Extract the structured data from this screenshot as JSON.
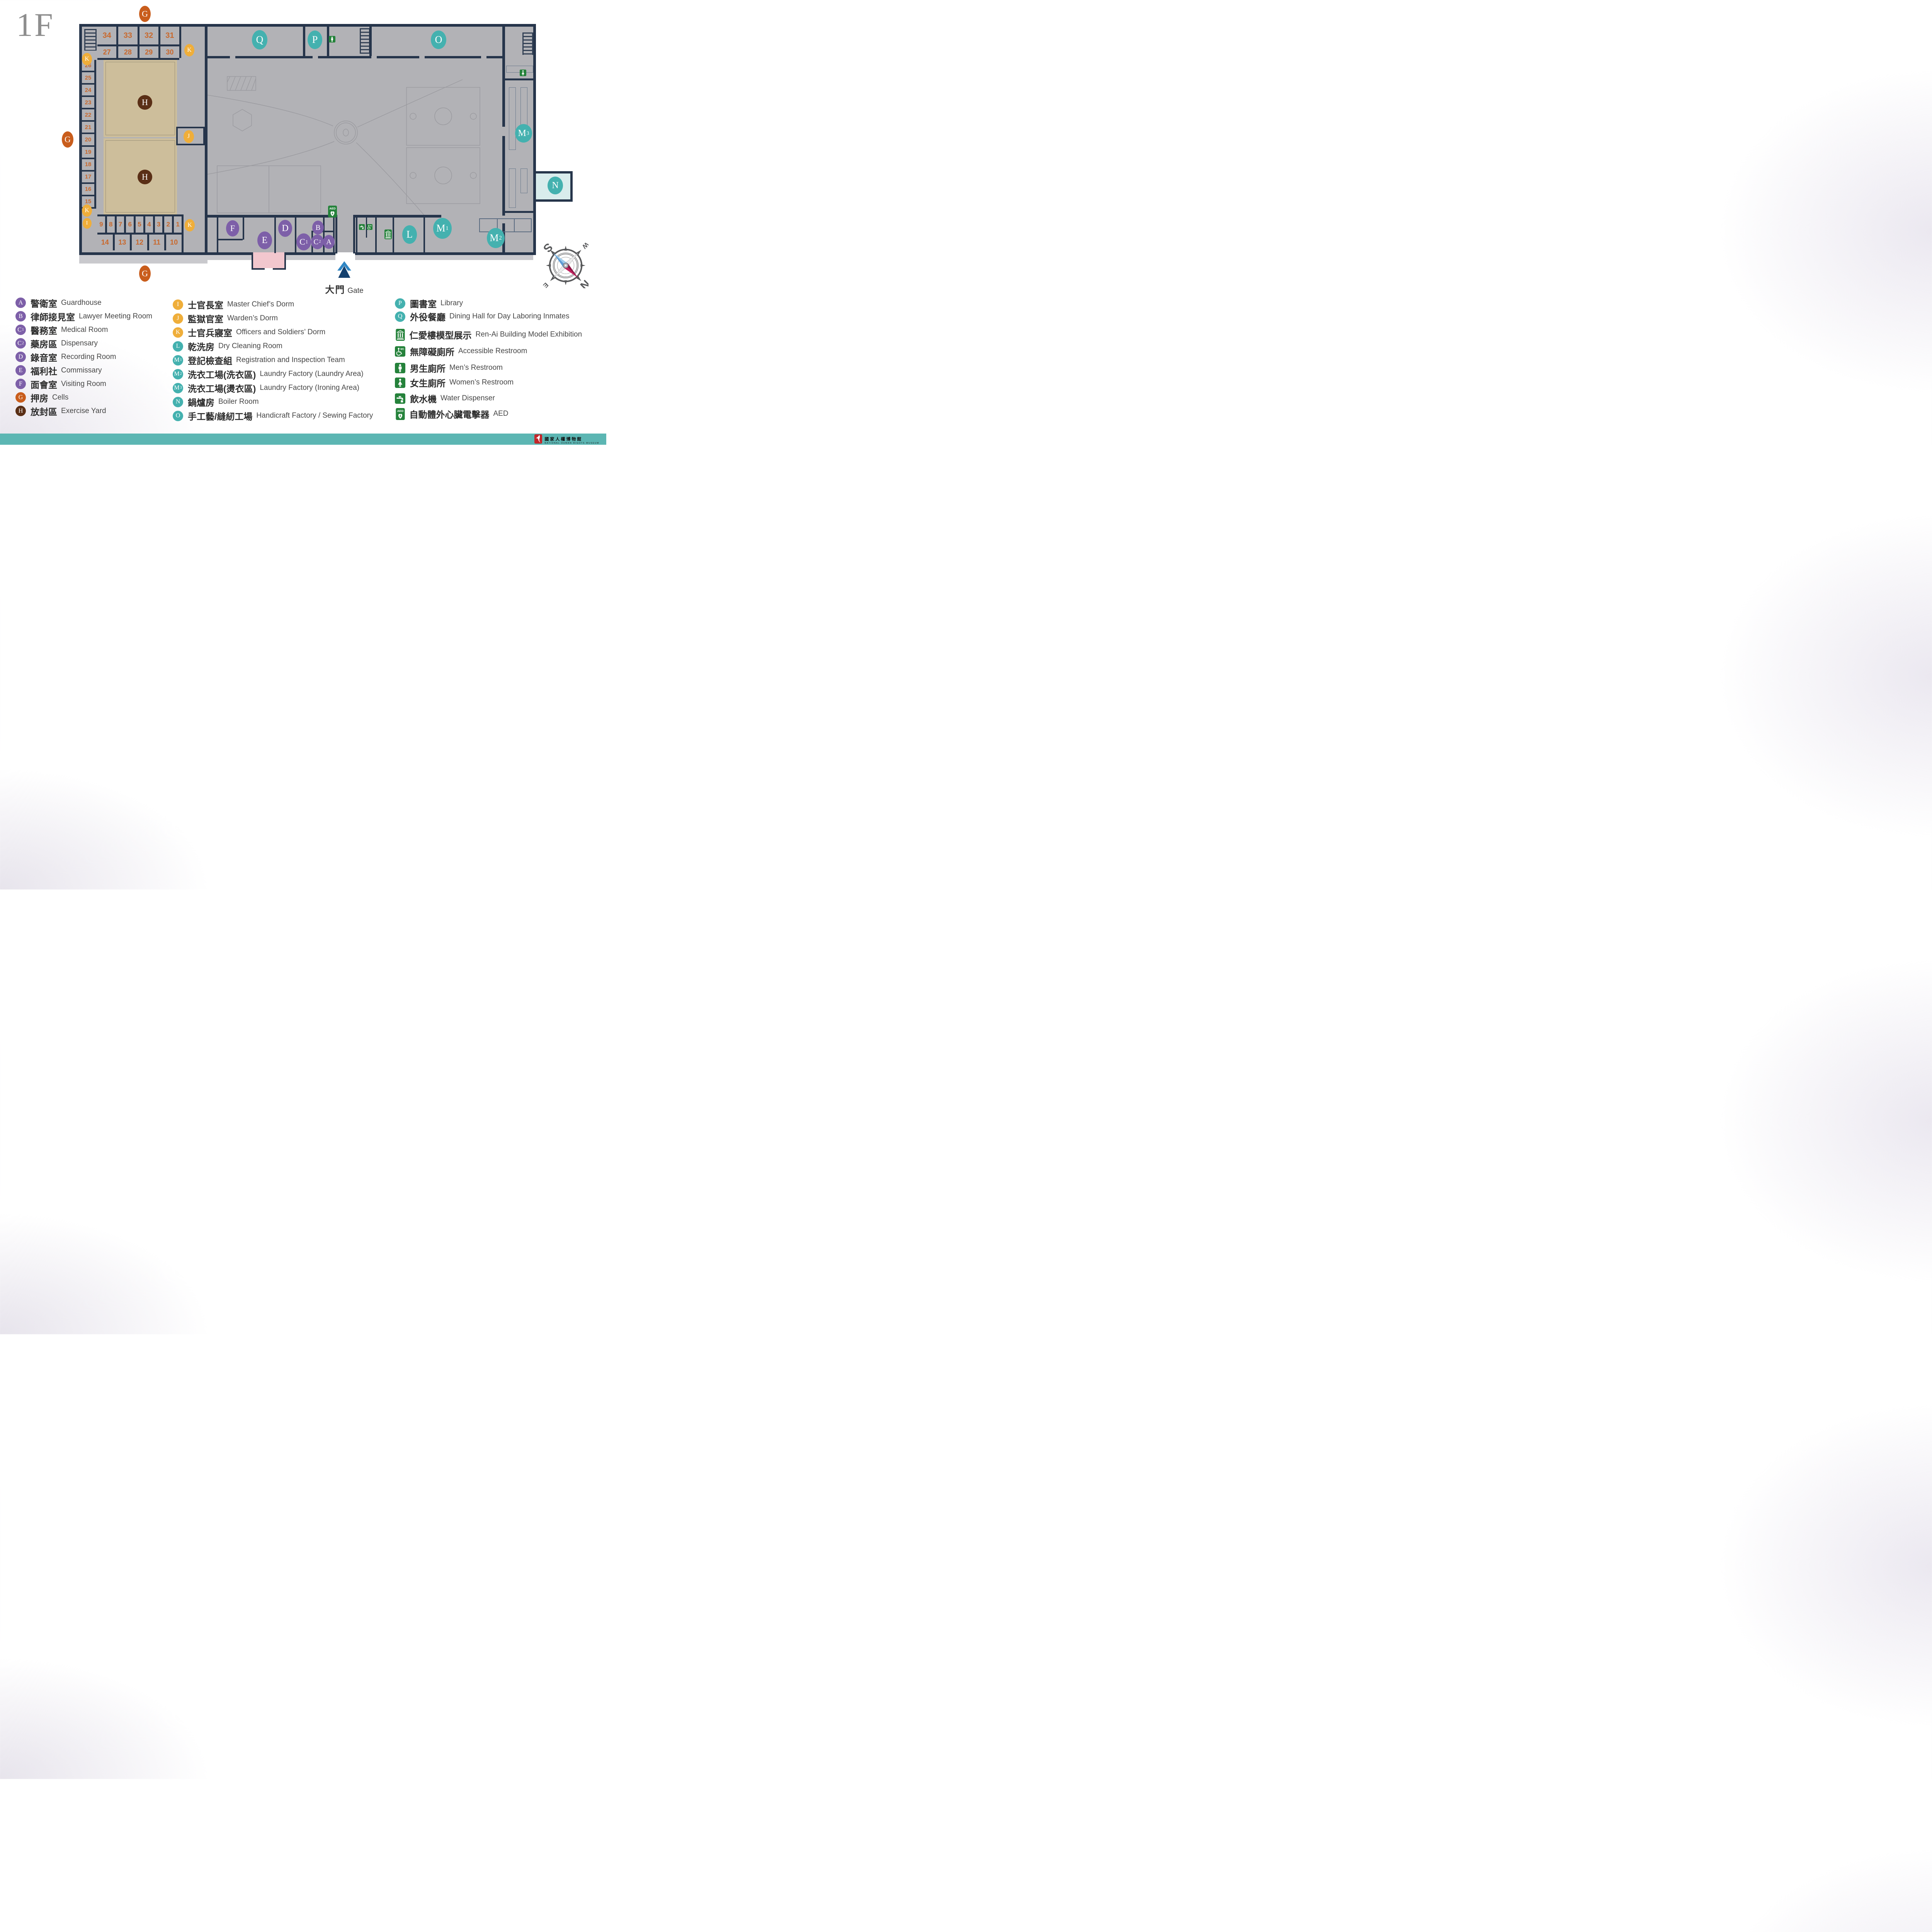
{
  "title": "1F",
  "palette": {
    "purple": "#7D5FA8",
    "orange": "#C95D1C",
    "brown": "#5A2F16",
    "yellow": "#EFAE3A",
    "teal": "#44B1AF",
    "green": "#25823B",
    "wall": "#26354B",
    "cell_beige": "#EDE1BE",
    "yard_tan": "#CDBE9B",
    "courtyard_gray": "#B2B2B6",
    "room_cyan": "#D9ECEC",
    "room_pink": "#F2C7CE",
    "footer_teal": "#5CB6B3",
    "number_orange": "#C9682C",
    "gate_blue_light": "#2F86C4",
    "gate_blue_dark": "#14406E",
    "logo_red": "#C3272B"
  },
  "map": {
    "cell_numbers": {
      "top_row_1": [
        "34",
        "33",
        "32",
        "31"
      ],
      "top_row_2": [
        "27",
        "28",
        "29",
        "30"
      ],
      "left_column": [
        "26",
        "25",
        "24",
        "23",
        "22",
        "21",
        "20",
        "19",
        "18",
        "17",
        "16",
        "15"
      ],
      "bottom_row_1": [
        "9",
        "8",
        "7",
        "6",
        "5",
        "4",
        "3",
        "2",
        "1"
      ],
      "bottom_row_2": [
        "14",
        "13",
        "12",
        "11",
        "10"
      ]
    },
    "markers": [
      {
        "letter": "G",
        "sub": "",
        "color": "orange"
      },
      {
        "letter": "G",
        "sub": "",
        "color": "orange"
      },
      {
        "letter": "G",
        "sub": "",
        "color": "orange"
      },
      {
        "letter": "K",
        "sub": "",
        "color": "yellow"
      },
      {
        "letter": "K",
        "sub": "",
        "color": "yellow"
      },
      {
        "letter": "K",
        "sub": "",
        "color": "yellow"
      },
      {
        "letter": "I",
        "sub": "",
        "color": "yellow"
      },
      {
        "letter": "K",
        "sub": "",
        "color": "yellow"
      },
      {
        "letter": "J",
        "sub": "",
        "color": "yellow"
      },
      {
        "letter": "H",
        "sub": "",
        "color": "brown"
      },
      {
        "letter": "H",
        "sub": "",
        "color": "brown"
      },
      {
        "letter": "Q",
        "sub": "",
        "color": "teal"
      },
      {
        "letter": "P",
        "sub": "",
        "color": "teal"
      },
      {
        "letter": "O",
        "sub": "",
        "color": "teal"
      },
      {
        "letter": "M",
        "sub": "3",
        "color": "teal"
      },
      {
        "letter": "N",
        "sub": "",
        "color": "teal"
      },
      {
        "letter": "L",
        "sub": "",
        "color": "teal"
      },
      {
        "letter": "M",
        "sub": "1",
        "color": "teal"
      },
      {
        "letter": "M",
        "sub": "2",
        "color": "teal"
      },
      {
        "letter": "F",
        "sub": "",
        "color": "purple"
      },
      {
        "letter": "E",
        "sub": "",
        "color": "purple"
      },
      {
        "letter": "D",
        "sub": "",
        "color": "purple"
      },
      {
        "letter": "C",
        "sub": "1",
        "color": "purple"
      },
      {
        "letter": "C",
        "sub": "2",
        "color": "purple"
      },
      {
        "letter": "B",
        "sub": "",
        "color": "purple"
      },
      {
        "letter": "A",
        "sub": "",
        "color": "purple"
      }
    ],
    "icons": [
      {
        "name": "men-restroom-icon"
      },
      {
        "name": "women-restroom-icon"
      },
      {
        "name": "aed-icon"
      },
      {
        "name": "water-dispenser-icon"
      },
      {
        "name": "accessible-restroom-icon"
      },
      {
        "name": "museum-icon"
      }
    ]
  },
  "gate": {
    "zh": "大門",
    "en": "Gate"
  },
  "compass": {
    "n": "N",
    "ne": "NE",
    "e": "E",
    "se": "SE",
    "s": "S",
    "sw": "SW",
    "w": "W",
    "nw": "NW"
  },
  "legend": {
    "columns": [
      {
        "items": [
          {
            "letter": "A",
            "sub": "",
            "color": "purple",
            "zh": "警衛室",
            "en": "Guardhouse"
          },
          {
            "letter": "B",
            "sub": "",
            "color": "purple",
            "zh": "律師接見室",
            "en": "Lawyer Meeting Room"
          },
          {
            "letter": "C",
            "sub": "1",
            "color": "purple",
            "zh": "醫務室",
            "en": "Medical Room"
          },
          {
            "letter": "C",
            "sub": "2",
            "color": "purple",
            "zh": "藥房區",
            "en": "Dispensary"
          },
          {
            "letter": "D",
            "sub": "",
            "color": "purple",
            "zh": "錄音室",
            "en": "Recording Room"
          },
          {
            "letter": "E",
            "sub": "",
            "color": "purple",
            "zh": "福利社",
            "en": "Commissary"
          },
          {
            "letter": "F",
            "sub": "",
            "color": "purple",
            "zh": "面會室",
            "en": "Visiting Room"
          },
          {
            "letter": "G",
            "sub": "",
            "color": "orange",
            "zh": "押房",
            "en": "Cells"
          },
          {
            "letter": "H",
            "sub": "",
            "color": "brown",
            "zh": "放封區",
            "en": "Exercise Yard"
          }
        ]
      },
      {
        "items": [
          {
            "letter": "I",
            "sub": "",
            "color": "yellow",
            "zh": "士官長室",
            "en": "Master Chief’s Dorm"
          },
          {
            "letter": "J",
            "sub": "",
            "color": "yellow",
            "zh": "監獄官室",
            "en": "Warden’s Dorm"
          },
          {
            "letter": "K",
            "sub": "",
            "color": "yellow",
            "zh": "士官兵寢室",
            "en": "Officers and Soldiers’ Dorm"
          },
          {
            "letter": "L",
            "sub": "",
            "color": "teal",
            "zh": "乾洗房",
            "en": "Dry Cleaning Room"
          },
          {
            "letter": "M",
            "sub": "1",
            "color": "teal",
            "zh": "登記檢查組",
            "en": "Registration and Inspection Team"
          },
          {
            "letter": "M",
            "sub": "2",
            "color": "teal",
            "zh": "洗衣工場(洗衣區)",
            "en": "Laundry Factory (Laundry Area)"
          },
          {
            "letter": "M",
            "sub": "3",
            "color": "teal",
            "zh": "洗衣工場(燙衣區)",
            "en": "Laundry Factory (Ironing Area)"
          },
          {
            "letter": "N",
            "sub": "",
            "color": "teal",
            "zh": "鍋爐房",
            "en": "Boiler Room"
          },
          {
            "letter": "O",
            "sub": "",
            "color": "teal",
            "zh": "手工藝/縫紉工場",
            "en": "Handicraft Factory / Sewing Factory"
          }
        ]
      },
      {
        "items": [
          {
            "letter": "P",
            "sub": "",
            "color": "teal",
            "zh": "圖書室",
            "en": "Library"
          },
          {
            "letter": "Q",
            "sub": "",
            "color": "teal",
            "zh": "外役餐廳",
            "en": "Dining Hall for Day Laboring Inmates"
          },
          {
            "icon": "museum-icon",
            "zh": "仁愛樓模型展示",
            "en": "Ren-Ai Building Model Exhibition"
          },
          {
            "icon": "accessible-restroom-icon",
            "zh": "無障礙廁所",
            "en": "Accessible Restroom"
          },
          {
            "icon": "men-restroom-icon",
            "zh": "男生廁所",
            "en": "Men’s Restroom"
          },
          {
            "icon": "women-restroom-icon",
            "zh": "女生廁所",
            "en": "Women’s Restroom"
          },
          {
            "icon": "water-dispenser-icon",
            "zh": "飲水機",
            "en": "Water Dispenser"
          },
          {
            "icon": "aed-icon",
            "zh": "自動體外心臟電擊器",
            "en": "AED"
          }
        ]
      }
    ]
  },
  "footer": {
    "zh": "國家人權博物館",
    "en": "NATIONAL HUMAN RIGHTS MUSEUM"
  }
}
